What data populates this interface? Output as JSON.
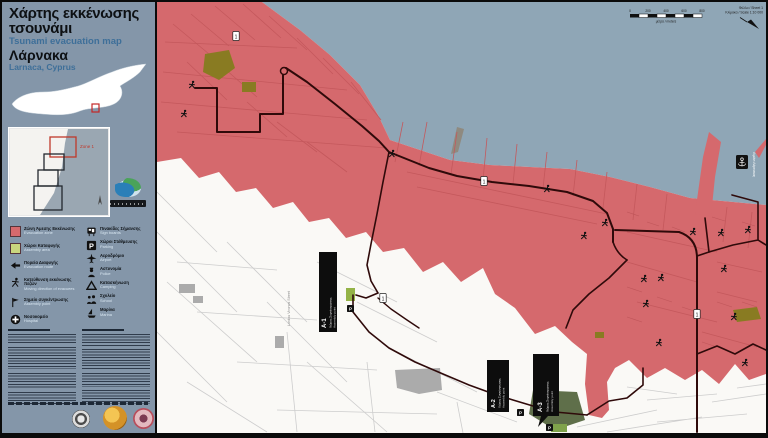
{
  "poster": {
    "title_el_line1": "Χάρτης εκκένωσης",
    "title_el_line2": "τσουνάμι",
    "title_en": "Tsunami evacuation map",
    "city_el": "Λάρνακα",
    "city_en": "Larnaca, Cyprus"
  },
  "inset": {
    "zone_label": "Zone 1"
  },
  "legend": {
    "left": [
      {
        "icon": "evacuation-zone-swatch",
        "el": "Ζώνη Άμεσης Εκκένωσης",
        "en": "Evacuation zone"
      },
      {
        "icon": "assembly-area-swatch",
        "el": "Χώροι Καταφυγής",
        "en": "Assembly area"
      },
      {
        "icon": "evacuation-route-arrow-icon",
        "el": "Πορεία Διαφυγής",
        "en": "Evacuation route"
      },
      {
        "icon": "evacuee-runner-icon",
        "el": "Κατεύθυνση εκκένωσης πεζών",
        "en": "Moving direction of evacuees"
      },
      {
        "icon": "assembly-point-flag-icon",
        "el": "Σημείο συγκέντρωσης",
        "en": "Assembly point"
      },
      {
        "icon": "hospital-icon",
        "el": "Νοσοκομείο",
        "en": "Hospital"
      }
    ],
    "right": [
      {
        "icon": "sign-board-icon",
        "el": "Πινακίδες Σήμανσης",
        "en": "Sign boards"
      },
      {
        "icon": "parking-icon",
        "el": "Χώροι Στάθμευσης",
        "en": "Parking"
      },
      {
        "icon": "airport-icon",
        "el": "Αεροδρόμιο",
        "en": "Airport"
      },
      {
        "icon": "police-icon",
        "el": "Αστυνομία",
        "en": "Police"
      },
      {
        "icon": "camping-icon",
        "el": "Κατασκήνωση",
        "en": "Camping"
      },
      {
        "icon": "school-icon",
        "el": "Σχολείο",
        "en": "School"
      },
      {
        "icon": "marina-icon",
        "el": "Μαρίνα",
        "en": "Marina"
      }
    ]
  },
  "map": {
    "notes": {
      "line1": "Φύλλο / Sheet 1",
      "line2": "Κλίμακα / Scale 1:10 000"
    },
    "scalebar": {
      "ticks": [
        "0",
        "200",
        "400",
        "600",
        "800"
      ],
      "caption": "μέτρα / meters"
    },
    "sign_label": "1",
    "marker_label": "P",
    "labels": {
      "a1": {
        "id": "A-1",
        "l1": "Χώρος Συγκέντρωσης",
        "l2": "Assembly point"
      },
      "a2": {
        "id": "A-2",
        "l1": "Χώρος Συγκέντρωσης",
        "l2": "Assembly point"
      },
      "a3": {
        "id": "A-3",
        "l1": "Χώρος Συγκέντρωσης",
        "l2": "Assembly point"
      },
      "port": "Λιμάνι Λάρνακας",
      "street": "Lordou Vironos Street"
    },
    "colors": {
      "sea": "#8FA6B6",
      "evacuation_zone": "#D5696D",
      "route": "#2F0A0A",
      "assembly_green": "#94B347"
    }
  }
}
